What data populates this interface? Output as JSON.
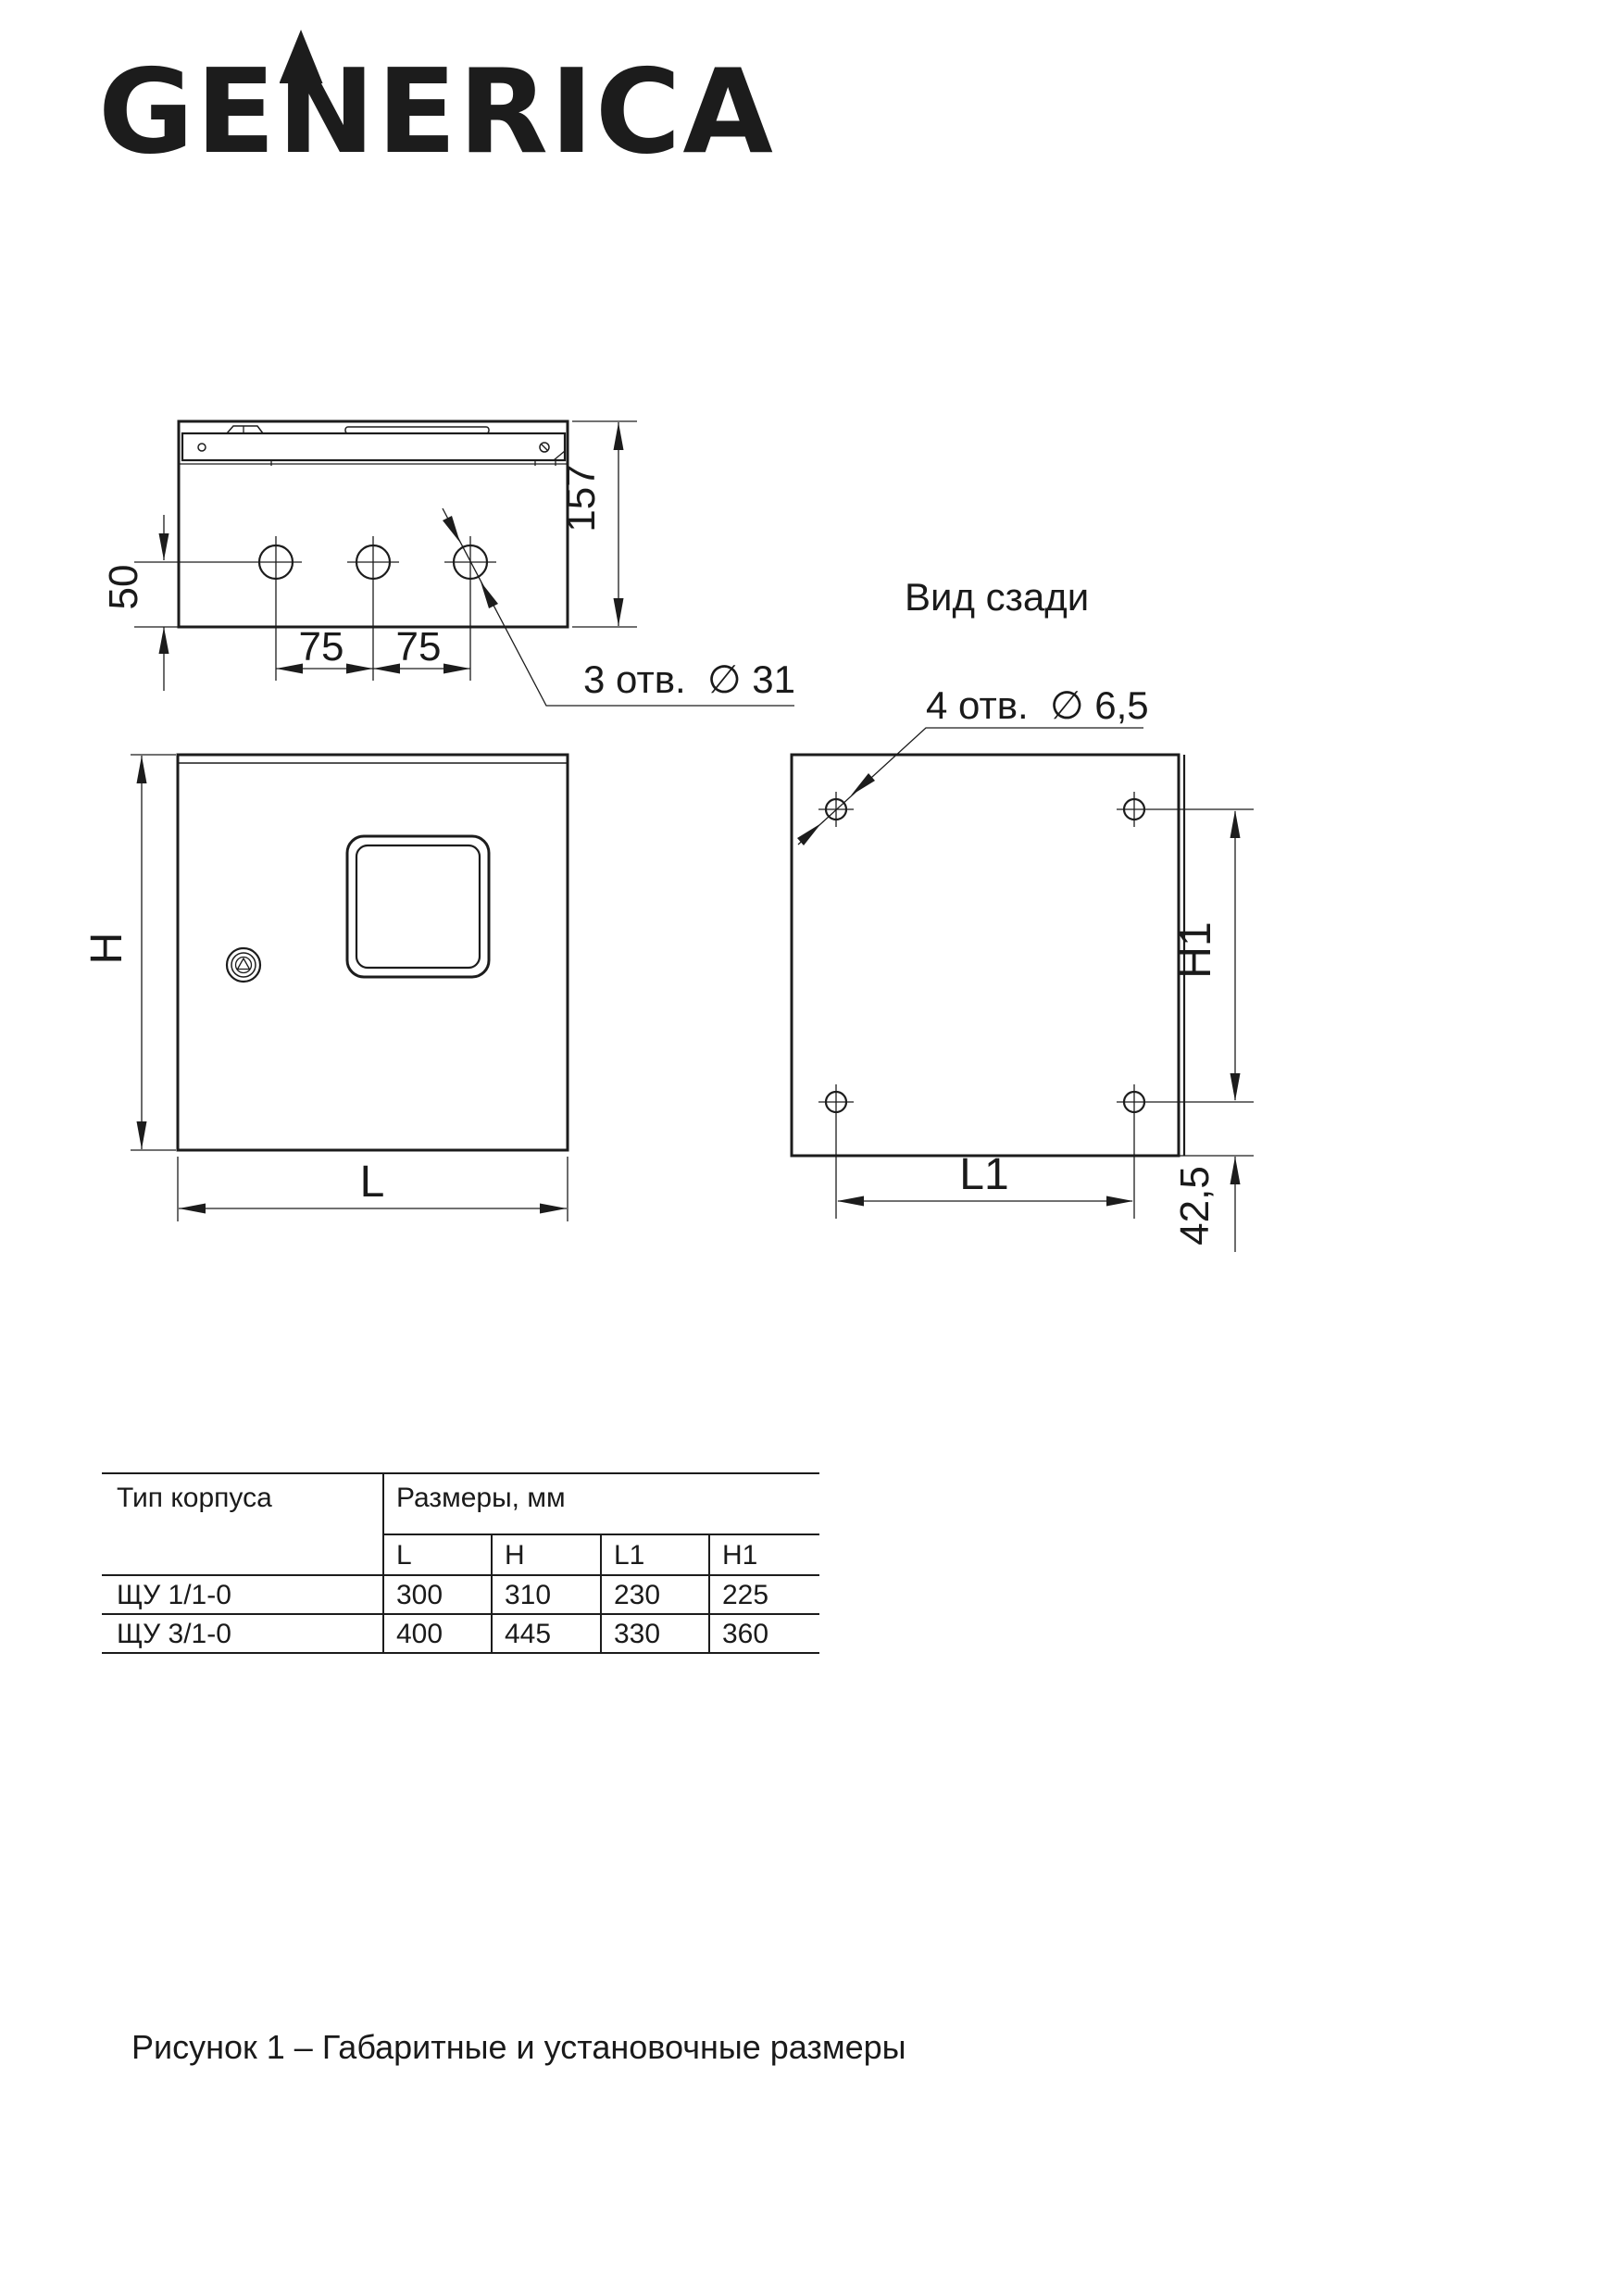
{
  "logo": {
    "text": "GENERICA",
    "part_left": "GE",
    "part_peak": "N",
    "part_right": "ERICA"
  },
  "drawing": {
    "top_view": {
      "depth_dim": "157",
      "hole_offset_dim": "50",
      "hole_spacing_dim_1": "75",
      "hole_spacing_dim_2": "75",
      "holes_note": "3 отв.  ∅ 31"
    },
    "front_view": {
      "height_dim": "H",
      "width_dim": "L"
    },
    "rear_view": {
      "title": "Вид сзади",
      "holes_note": "4 отв.  ∅ 6,5",
      "height_dim": "H1",
      "width_dim": "L1",
      "bottom_offset_dim": "42,5"
    }
  },
  "table": {
    "col_type": "Тип корпуса",
    "col_dimensions": "Размеры, мм",
    "sub_columns": [
      "L",
      "H",
      "L1",
      "H1"
    ],
    "rows": [
      {
        "type": "ЩУ 1/1-0",
        "L": "300",
        "H": "310",
        "L1": "230",
        "H1": "225"
      },
      {
        "type": "ЩУ 3/1-0",
        "L": "400",
        "H": "445",
        "L1": "330",
        "H1": "360"
      }
    ]
  },
  "caption": "Рисунок 1 – Габаритные и установочные размеры",
  "colors": {
    "line": "#1c1c1c",
    "text": "#1a1a1a",
    "background": "#ffffff"
  }
}
